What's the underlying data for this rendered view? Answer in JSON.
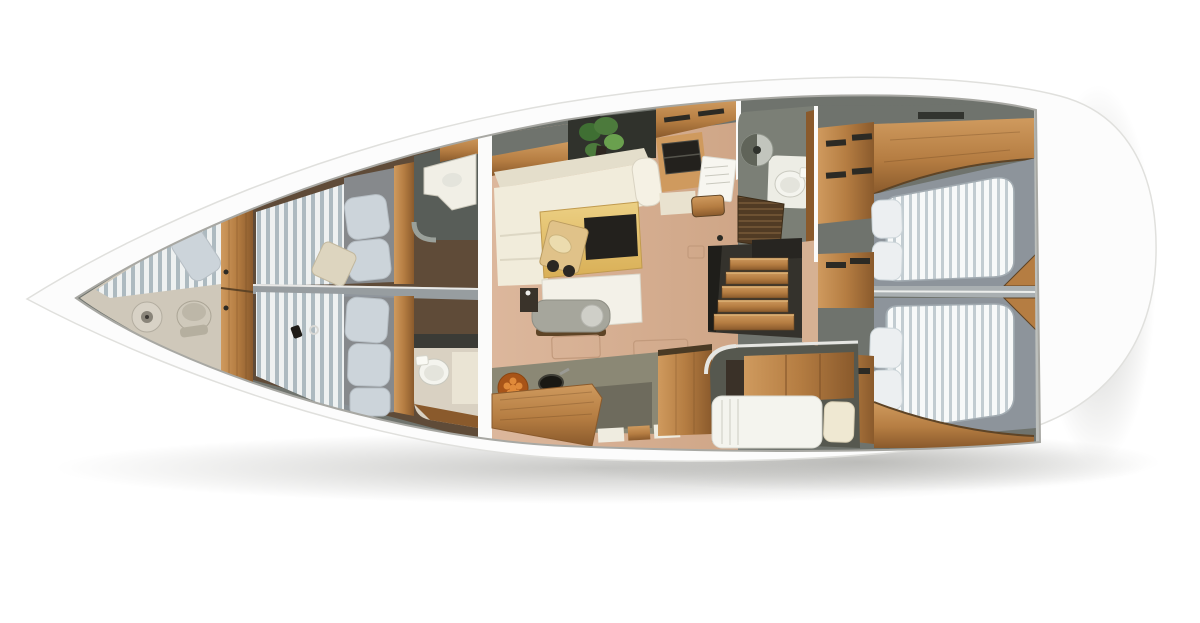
{
  "title": "Sailing yacht interior layout plan - top-down cutaway 3D rendering",
  "view": "top-down cutaway, bow pointing left, rounded stern to the right, soft drop shadow on white background",
  "palette": {
    "bg": "#ffffff",
    "hull": "#fcfcfc",
    "hull_edge": "#e0e0dd",
    "rim_line": "#a8a8a3",
    "deck_gray": "#6f736d",
    "floor_bow": "#cfc8ba",
    "floor_dark": "#5f4b38",
    "floor_tan1": "#dcb79c",
    "floor_tan2": "#cfa687",
    "wood_light": "#cf9a5e",
    "wood_mid": "#b57d42",
    "wood_dark": "#8a5a2c",
    "wood_deep": "#5e4426",
    "slat_light": "#eef1f1",
    "slat_dark": "#adbac0",
    "matt_light": "#f7f9f9",
    "matt_dark": "#c2ccd1",
    "berth_gray": "#8d949b",
    "pillow_gray": "#ccd4da",
    "pillow_white": "#eceff1",
    "pillow_cream": "#efe8d2",
    "cushion_beige": "#ddd5bf",
    "sofa_cream": "#f1ecdb",
    "sofa_shadow": "#e4decb",
    "table_wood1": "#ecd084",
    "table_wood2": "#d9af56",
    "white_table": "#f3f1e8",
    "bench_gray": "#a6a69c",
    "bench_disc": "#cfcfc8",
    "counter": "#8b8875",
    "counter_dark": "#6e6b5d",
    "head_wall": "#7b7f76",
    "head_wall_dark": "#585d58",
    "teak1": "#513b24",
    "teak2": "#6e5233",
    "plant1": "#4c7a3c",
    "plant2": "#6aa04e",
    "plant3": "#3f6f33",
    "orange": "#a85418",
    "orange_dot": "#e08a3a",
    "dark_item": "#23211d",
    "fixture": "#f4f4ee",
    "fixture_in": "#e4e4dc",
    "divider": "#a9afb1",
    "divider_fwd": "#979da0",
    "transom": "#bcbfbc",
    "util_wall": "#56584f",
    "paper": "#f7f6f0",
    "vanity": "#f1efe6",
    "shadow": "#9c9c98"
  },
  "vessel": {
    "sections": [
      {
        "id": "forepeak",
        "label": "Bow washroom / forepeak",
        "features": [
          "round sink",
          "toilet stool",
          "slatted v-berth",
          "grey pillow"
        ]
      },
      {
        "id": "bulkhead-fwd",
        "label": "Forward wood bulkhead doors",
        "features": [
          "two stacked wood door panels"
        ]
      },
      {
        "id": "forward-cabin-port",
        "label": "Forward cabin (port)",
        "features": [
          "slatted berth",
          "grey mattress",
          "two grey pillows",
          "beige decor cushion"
        ]
      },
      {
        "id": "forward-cabin-starboard",
        "label": "Forward cabin (starboard)",
        "features": [
          "slatted berth",
          "grey mattress",
          "three grey pillows",
          "small personal items"
        ]
      },
      {
        "id": "forward-head-port",
        "label": "Forward head (port)",
        "features": [
          "white vanity with basin",
          "wood locker",
          "curved wall"
        ]
      },
      {
        "id": "forward-head-starboard",
        "label": "Forward head (starboard)",
        "features": [
          "white toilet",
          "beige shower floor",
          "wood trim"
        ]
      },
      {
        "id": "main-bulkhead",
        "label": "Main bulkhead (white gap at mast)",
        "features": []
      },
      {
        "id": "saloon",
        "label": "Saloon",
        "features": [
          "cream L-shaped sofa",
          "wood dining table with dark leaf",
          "cutting board and cups",
          "white sideboard",
          "grey bench seat",
          "green plant",
          "dark cabinet",
          "floor hatches"
        ]
      },
      {
        "id": "galley",
        "label": "Galley",
        "features": [
          "olive-grey counter",
          "dark sink",
          "bowl of oranges",
          "wood peninsula",
          "drawer bank",
          "wood tall unit"
        ]
      },
      {
        "id": "nav-station",
        "label": "Navigation station",
        "features": [
          "wood chart desk",
          "dark laptop",
          "white chart sheet",
          "wood stool",
          "overhead lockers"
        ]
      },
      {
        "id": "aft-head",
        "label": "Aft head",
        "features": [
          "round basin",
          "white toilet",
          "dark teak shower grate",
          "wood door jamb"
        ]
      },
      {
        "id": "companionway",
        "label": "Companionway stairs",
        "features": [
          "five wood treads",
          "dark surround"
        ]
      },
      {
        "id": "aft-cabin-port",
        "label": "Aft cabin (port)",
        "features": [
          "double berth with striped mattress",
          "two white pillows",
          "wood locker with handles",
          "curved wood shelf beam",
          "wood foot wedge"
        ]
      },
      {
        "id": "aft-cabin-starboard",
        "label": "Aft cabin (starboard)",
        "features": [
          "double berth with striped mattress",
          "two white pillows",
          "wood lockers",
          "curved wood shelf beam",
          "wood foot wedge"
        ]
      },
      {
        "id": "utility-cabin",
        "label": "Single-berth utility cabin",
        "features": [
          "white single berth",
          "cream pillow",
          "wood shelf unit",
          "rounded wall"
        ]
      },
      {
        "id": "stern-deck",
        "label": "White stern deck behind transom wall",
        "features": []
      }
    ],
    "berth_count": 6,
    "head_count": 3
  }
}
